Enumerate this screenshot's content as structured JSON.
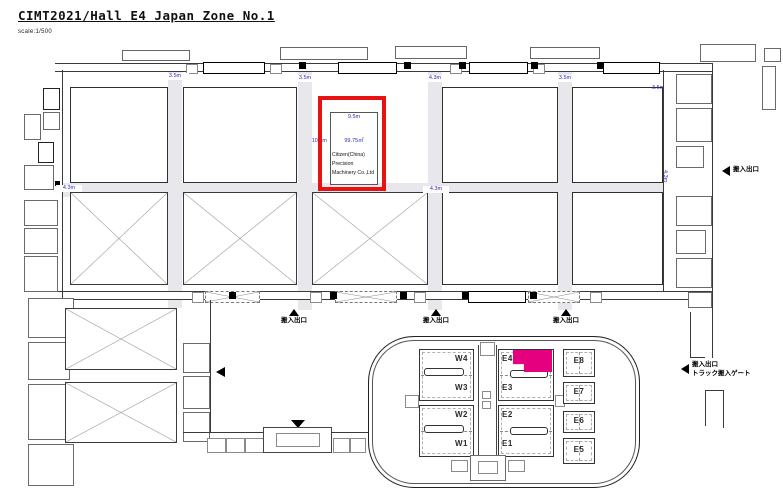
{
  "header": {
    "title": "CIMT2021/Hall E4 Japan Zone No.1",
    "scale_note": "scale:1/500"
  },
  "highlight_booth": {
    "width_label": "9.5m",
    "depth_label": "10.5m",
    "area_label": "99.75㎡",
    "company_lines": [
      "Citizen(China)",
      "Precision",
      "Machinery Co.,Ltd"
    ]
  },
  "dim_labels": [
    "3.5m",
    "3.5m",
    "4.3m",
    "3.5m",
    "3.5m",
    "4.3m",
    "4.3m",
    "4.3m"
  ],
  "gates": {
    "load_entrance": "搬入出口",
    "truck_line1": "搬入出口",
    "truck_line2": "トラック搬入ゲート"
  },
  "inset_map": {
    "west_halls": [
      "W4",
      "W3",
      "W2",
      "W1"
    ],
    "east_halls": [
      "E4",
      "E3",
      "E2",
      "E1"
    ],
    "side_halls": [
      "E8",
      "E7",
      "E6",
      "E5"
    ],
    "highlight_hall": "E4",
    "highlight_color": "#e4007f"
  },
  "colors": {
    "highlight_box": "#e81212",
    "dimension_text": "#2b2bb4",
    "corridor": "#e8e8ec"
  }
}
